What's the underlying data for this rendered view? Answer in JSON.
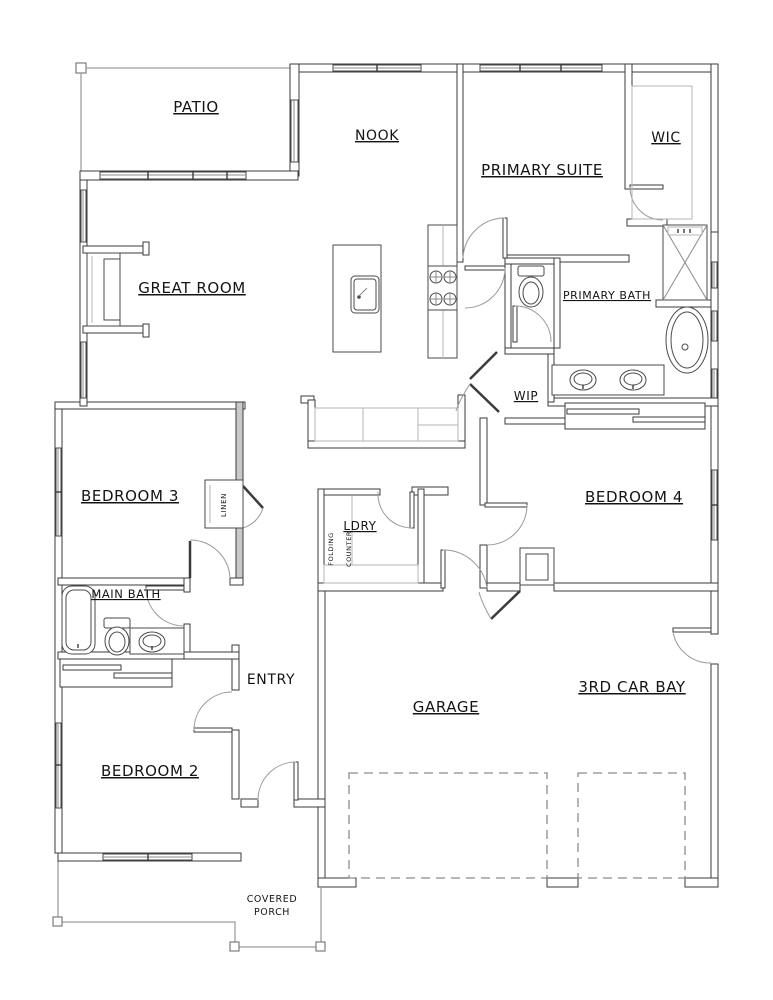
{
  "drawing": {
    "kind": "residential floor plan",
    "colors": {
      "ink": "#3b3b3b",
      "light_line": "#9e9e9e",
      "background": "#ffffff"
    }
  },
  "rooms": {
    "patio": {
      "label": "PATIO"
    },
    "nook": {
      "label": "NOOK"
    },
    "primary_suite": {
      "label": "PRIMARY SUITE"
    },
    "wic": {
      "label": "WIC"
    },
    "great_room": {
      "label": "GREAT ROOM"
    },
    "primary_bath": {
      "label": "PRIMARY BATH"
    },
    "wip": {
      "label": "WIP"
    },
    "bedroom3": {
      "label": "BEDROOM 3"
    },
    "bedroom4": {
      "label": "BEDROOM 4"
    },
    "laundry": {
      "label": "LDRY"
    },
    "linen": {
      "label": "LINEN"
    },
    "folding_counter": {
      "line1": "FOLDING",
      "line2": "COUNTER"
    },
    "main_bath": {
      "label": "MAIN BATH"
    },
    "entry": {
      "label": "ENTRY"
    },
    "bedroom2": {
      "label": "BEDROOM 2"
    },
    "garage": {
      "label": "GARAGE"
    },
    "third_car_bay": {
      "label": "3RD CAR BAY"
    },
    "covered_porch": {
      "line1": "COVERED",
      "line2": "PORCH"
    }
  }
}
